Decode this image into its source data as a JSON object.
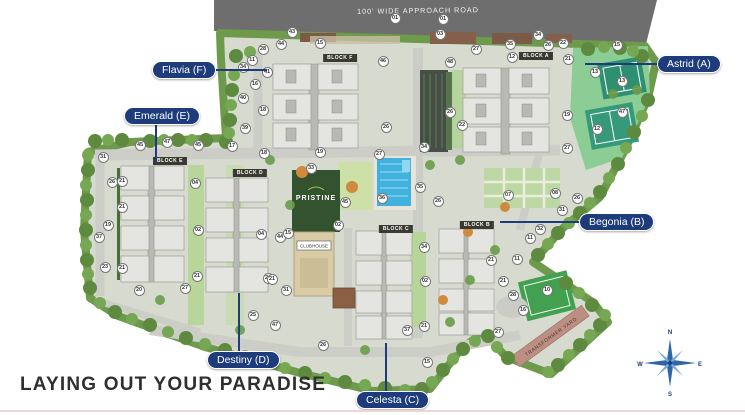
{
  "title": "LAYING OUT YOUR PARADISE",
  "road": {
    "label": "100' WIDE APPROACH ROAD"
  },
  "site": {
    "logo": "PRISTINE",
    "clubhouse_label": "CLUBHOUSE",
    "transformer_yard_label": "TRANSFORMER YARD"
  },
  "compass": {
    "n": "N",
    "e": "E",
    "s": "S",
    "w": "W"
  },
  "blocks": [
    {
      "label": "BLOCK F",
      "x": 340,
      "y": 58
    },
    {
      "label": "BLOCK A",
      "x": 536,
      "y": 56
    },
    {
      "label": "BLOCK E",
      "x": 170,
      "y": 161
    },
    {
      "label": "BLOCK D",
      "x": 250,
      "y": 173
    },
    {
      "label": "BLOCK C",
      "x": 396,
      "y": 229
    },
    {
      "label": "BLOCK B",
      "x": 477,
      "y": 225
    }
  ],
  "callouts": [
    {
      "label": "Flavia (F)",
      "px": 152,
      "py": 61,
      "orient": "h",
      "lx": 216,
      "ly": 70,
      "len": 51
    },
    {
      "label": "Astrid (A)",
      "px": 657,
      "py": 55,
      "orient": "h",
      "lx": 585,
      "ly": 64,
      "len": 72
    },
    {
      "label": "Emerald (E)",
      "px": 124,
      "py": 107,
      "orient": "v",
      "lx": 156,
      "ly": 125,
      "len": 38
    },
    {
      "label": "Begonia (B)",
      "px": 579,
      "py": 213,
      "orient": "h",
      "lx": 500,
      "ly": 222,
      "len": 79
    },
    {
      "label": "Destiny (D)",
      "px": 207,
      "py": 351,
      "orient": "v",
      "lx": 239,
      "ly": 293,
      "len": 58
    },
    {
      "label": "Celesta (C)",
      "px": 356,
      "py": 391,
      "orient": "v",
      "lx": 386,
      "ly": 343,
      "len": 48
    }
  ],
  "markers": [
    {
      "n": "01",
      "x": 395,
      "y": 18
    },
    {
      "n": "01",
      "x": 443,
      "y": 19
    },
    {
      "n": "03",
      "x": 440,
      "y": 34
    },
    {
      "n": "43",
      "x": 292,
      "y": 32
    },
    {
      "n": "44",
      "x": 281,
      "y": 44
    },
    {
      "n": "28",
      "x": 263,
      "y": 49
    },
    {
      "n": "11",
      "x": 252,
      "y": 60
    },
    {
      "n": "15",
      "x": 320,
      "y": 43
    },
    {
      "n": "34",
      "x": 243,
      "y": 67
    },
    {
      "n": "41",
      "x": 267,
      "y": 72
    },
    {
      "n": "16",
      "x": 255,
      "y": 84
    },
    {
      "n": "40",
      "x": 243,
      "y": 98
    },
    {
      "n": "18",
      "x": 263,
      "y": 110
    },
    {
      "n": "39",
      "x": 245,
      "y": 128
    },
    {
      "n": "46",
      "x": 383,
      "y": 61
    },
    {
      "n": "19",
      "x": 320,
      "y": 152
    },
    {
      "n": "26",
      "x": 386,
      "y": 127
    },
    {
      "n": "27",
      "x": 379,
      "y": 154
    },
    {
      "n": "45",
      "x": 140,
      "y": 145
    },
    {
      "n": "47",
      "x": 167,
      "y": 142
    },
    {
      "n": "45",
      "x": 198,
      "y": 145
    },
    {
      "n": "17",
      "x": 232,
      "y": 146
    },
    {
      "n": "18",
      "x": 264,
      "y": 153
    },
    {
      "n": "31",
      "x": 103,
      "y": 157
    },
    {
      "n": "26",
      "x": 112,
      "y": 182
    },
    {
      "n": "21",
      "x": 122,
      "y": 181
    },
    {
      "n": "04",
      "x": 195,
      "y": 183
    },
    {
      "n": "21",
      "x": 122,
      "y": 207
    },
    {
      "n": "19",
      "x": 108,
      "y": 225
    },
    {
      "n": "37",
      "x": 99,
      "y": 237
    },
    {
      "n": "02",
      "x": 198,
      "y": 230
    },
    {
      "n": "23",
      "x": 105,
      "y": 267
    },
    {
      "n": "21",
      "x": 122,
      "y": 268
    },
    {
      "n": "20",
      "x": 139,
      "y": 290
    },
    {
      "n": "27",
      "x": 185,
      "y": 288
    },
    {
      "n": "21",
      "x": 197,
      "y": 276
    },
    {
      "n": "21",
      "x": 268,
      "y": 278
    },
    {
      "n": "25",
      "x": 253,
      "y": 315
    },
    {
      "n": "47",
      "x": 275,
      "y": 325
    },
    {
      "n": "26",
      "x": 323,
      "y": 345
    },
    {
      "n": "04",
      "x": 261,
      "y": 234
    },
    {
      "n": "44",
      "x": 280,
      "y": 237
    },
    {
      "n": "15",
      "x": 288,
      "y": 233
    },
    {
      "n": "31",
      "x": 286,
      "y": 290
    },
    {
      "n": "21",
      "x": 272,
      "y": 279
    },
    {
      "n": "33",
      "x": 311,
      "y": 168
    },
    {
      "n": "45",
      "x": 345,
      "y": 202
    },
    {
      "n": "36",
      "x": 382,
      "y": 198
    },
    {
      "n": "35",
      "x": 420,
      "y": 187
    },
    {
      "n": "26",
      "x": 438,
      "y": 201
    },
    {
      "n": "02",
      "x": 338,
      "y": 225
    },
    {
      "n": "34",
      "x": 424,
      "y": 147
    },
    {
      "n": "34",
      "x": 424,
      "y": 247
    },
    {
      "n": "02",
      "x": 425,
      "y": 281
    },
    {
      "n": "34",
      "x": 538,
      "y": 35
    },
    {
      "n": "26",
      "x": 548,
      "y": 45
    },
    {
      "n": "22",
      "x": 563,
      "y": 43
    },
    {
      "n": "27",
      "x": 476,
      "y": 49
    },
    {
      "n": "35",
      "x": 510,
      "y": 44
    },
    {
      "n": "12",
      "x": 512,
      "y": 57
    },
    {
      "n": "48",
      "x": 450,
      "y": 62
    },
    {
      "n": "21",
      "x": 568,
      "y": 59
    },
    {
      "n": "26",
      "x": 450,
      "y": 112
    },
    {
      "n": "22",
      "x": 462,
      "y": 125
    },
    {
      "n": "19",
      "x": 567,
      "y": 115
    },
    {
      "n": "27",
      "x": 567,
      "y": 148
    },
    {
      "n": "15",
      "x": 617,
      "y": 45
    },
    {
      "n": "13",
      "x": 595,
      "y": 72
    },
    {
      "n": "13",
      "x": 622,
      "y": 81
    },
    {
      "n": "47",
      "x": 622,
      "y": 112
    },
    {
      "n": "12",
      "x": 597,
      "y": 129
    },
    {
      "n": "10",
      "x": 547,
      "y": 290
    },
    {
      "n": "21",
      "x": 503,
      "y": 281
    },
    {
      "n": "28",
      "x": 513,
      "y": 295
    },
    {
      "n": "16",
      "x": 523,
      "y": 310
    },
    {
      "n": "27",
      "x": 498,
      "y": 332
    },
    {
      "n": "37",
      "x": 407,
      "y": 330
    },
    {
      "n": "21",
      "x": 424,
      "y": 326
    },
    {
      "n": "15",
      "x": 427,
      "y": 362
    },
    {
      "n": "07",
      "x": 508,
      "y": 195
    },
    {
      "n": "08",
      "x": 555,
      "y": 193
    },
    {
      "n": "26",
      "x": 577,
      "y": 198
    },
    {
      "n": "31",
      "x": 562,
      "y": 210
    },
    {
      "n": "32",
      "x": 540,
      "y": 229
    },
    {
      "n": "11",
      "x": 530,
      "y": 238
    },
    {
      "n": "11",
      "x": 517,
      "y": 259
    },
    {
      "n": "21",
      "x": 491,
      "y": 260
    }
  ]
}
